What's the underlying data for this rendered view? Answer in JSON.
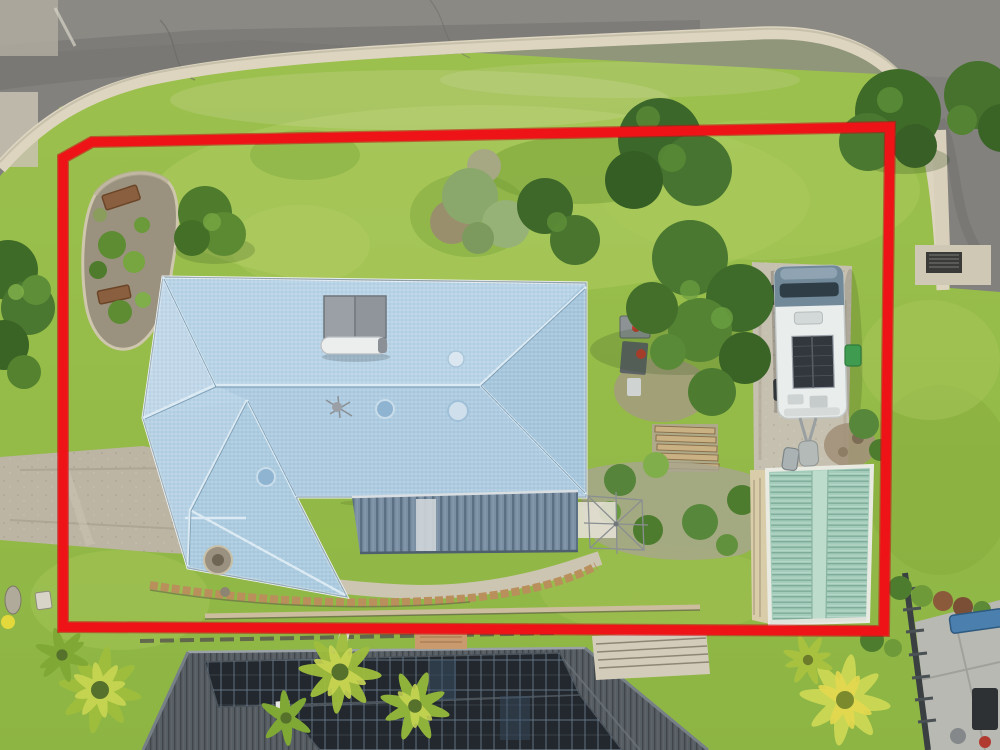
{
  "scene": {
    "type": "aerial-drone-photo",
    "subject": "residential property lot with red boundary outline drawn over photo",
    "annotation": {
      "name": "property-boundary",
      "shape": "polygon",
      "color": "#ee1316"
    }
  },
  "colors": {
    "grass": "#96bc49",
    "grass_light": "#b4cf65",
    "grass_dark": "#6f9a33",
    "road": "#82817d",
    "road_dark": "#6e6d69",
    "kerb": "#ddd5c0",
    "concrete": "#c2bcab",
    "roof_main": "#b7d3e6",
    "roof_light": "#c6dcec",
    "roof_dark": "#a3c4da",
    "roof_ridge": "#dceaf3",
    "patio_roof": "#7a8fa3",
    "shed_roof": "#a3ccba",
    "shed_trim": "#e9eae2",
    "caravan_body": "#e9edec",
    "caravan_cab": "#718999",
    "solar_panel": "#32373d",
    "neighbor_roof": "#565d63",
    "neighbor_solar": "#23282e",
    "palm": "#c9d653",
    "tree": "#4a7830",
    "tree_dark": "#3c672a",
    "garden_mulch": "#9a927f",
    "timber": "#b98f5c",
    "boundary": "#ee1316"
  }
}
